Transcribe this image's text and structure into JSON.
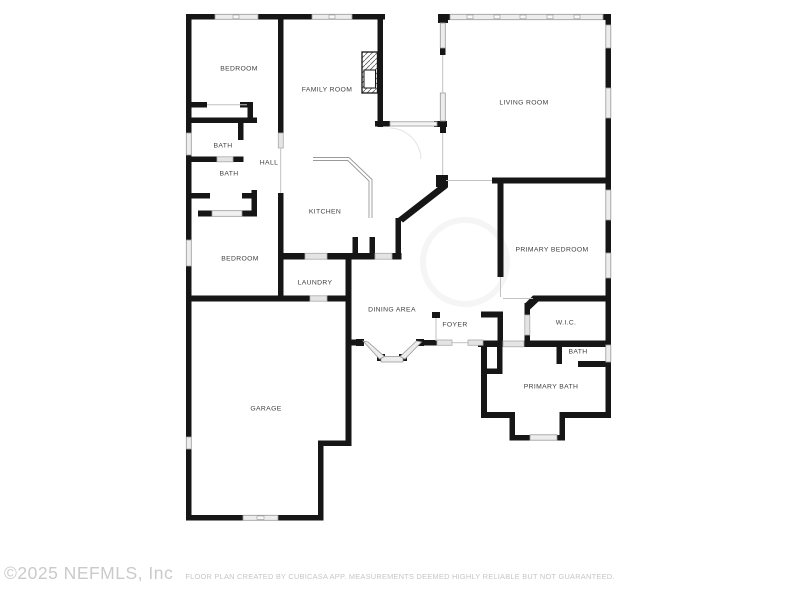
{
  "plan": {
    "colors": {
      "wall": "#161616",
      "window_fill": "#ededed",
      "window_stroke": "#999999",
      "door_fill": "#e4e4e4",
      "label_text": "#3f3f3f",
      "watermark_text": "#cacaca"
    },
    "rooms": [
      {
        "id": "bedroom-1",
        "name": "BEDROOM"
      },
      {
        "id": "family-room",
        "name": "FAMILY ROOM"
      },
      {
        "id": "living-room",
        "name": "LIVING ROOM"
      },
      {
        "id": "bath-1",
        "name": "BATH"
      },
      {
        "id": "bath-2",
        "name": "BATH"
      },
      {
        "id": "hall",
        "name": "HALL"
      },
      {
        "id": "kitchen",
        "name": "KITCHEN"
      },
      {
        "id": "bedroom-2",
        "name": "BEDROOM"
      },
      {
        "id": "laundry",
        "name": "LAUNDRY"
      },
      {
        "id": "primary-bedroom",
        "name": "PRIMARY BEDROOM"
      },
      {
        "id": "dining-area",
        "name": "DINING AREA"
      },
      {
        "id": "foyer",
        "name": "FOYER"
      },
      {
        "id": "wic",
        "name": "W.I.C."
      },
      {
        "id": "bath-3",
        "name": "BATH"
      },
      {
        "id": "primary-bath",
        "name": "PRIMARY BATH"
      },
      {
        "id": "garage",
        "name": "GARAGE"
      }
    ]
  },
  "footer": {
    "copyright": "©2025 NEFMLS, Inc",
    "disclaimer": "FLOOR PLAN CREATED BY CUBICASA APP. MEASUREMENTS DEEMED HIGHLY RELIABLE BUT NOT GUARANTEED."
  }
}
